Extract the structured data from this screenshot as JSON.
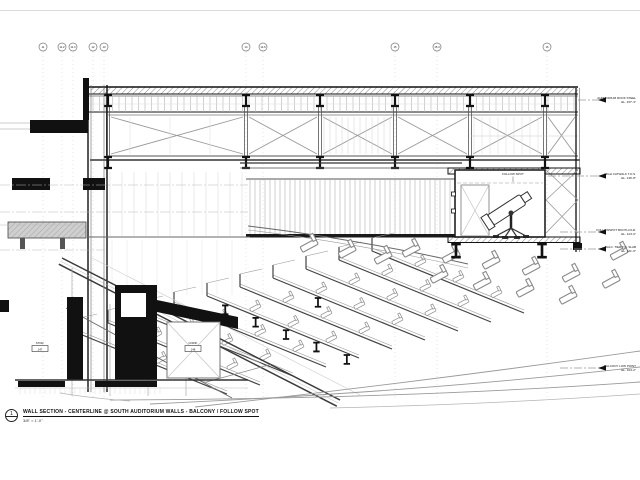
{
  "drawing": {
    "background": "#ffffff",
    "ink": "#1a1a1a",
    "light_line": "#9a9a9a",
    "poche": "#111111",
    "concrete_gray": "#cfcfcf"
  },
  "grid_bubbles": [
    {
      "label": "11",
      "x": 43
    },
    {
      "label": "11.2",
      "x": 62
    },
    {
      "label": "11.4",
      "x": 73
    },
    {
      "label": "12",
      "x": 93
    },
    {
      "label": "13",
      "x": 104
    },
    {
      "label": "14",
      "x": 246
    },
    {
      "label": "14.6",
      "x": 263
    },
    {
      "label": "15",
      "x": 395
    },
    {
      "label": "15.3",
      "x": 437
    },
    {
      "label": "16",
      "x": 547
    }
  ],
  "annotations_right": [
    {
      "y": 100,
      "line1": "AUDITORIUM ROOF STEEL",
      "line2": "EL. 157'-4\""
    },
    {
      "y": 176,
      "line1": "HIGH CATWALK T.O.S.",
      "line2": "EL. 136'-8\""
    },
    {
      "y": 232,
      "line1": "FOLLOWSPOT BOOTH FLR.",
      "line2": "EL. 124'-0\""
    },
    {
      "y": 249,
      "line1": "BALC. TIER T.O. SLAB",
      "line2": "EL. 121'-6\""
    },
    {
      "y": 368,
      "line1": "BALCONY LOW POINT",
      "line2": "EL. 104'-2\""
    }
  ],
  "room_tags": [
    {
      "x": 40,
      "y": 344,
      "name": "STOR.",
      "number": "147"
    },
    {
      "x": 193,
      "y": 344,
      "name": "CORR.",
      "number": "148"
    }
  ],
  "booth": {
    "label": "FOLLOW SPOT"
  },
  "title_block": {
    "number": "1",
    "title": "WALL SECTION - CENTERLINE @ SOUTH AUDITORIUM WALLS - BALCONY / FOLLOW SPOT",
    "scale": "3/8\" = 1'-0\""
  }
}
